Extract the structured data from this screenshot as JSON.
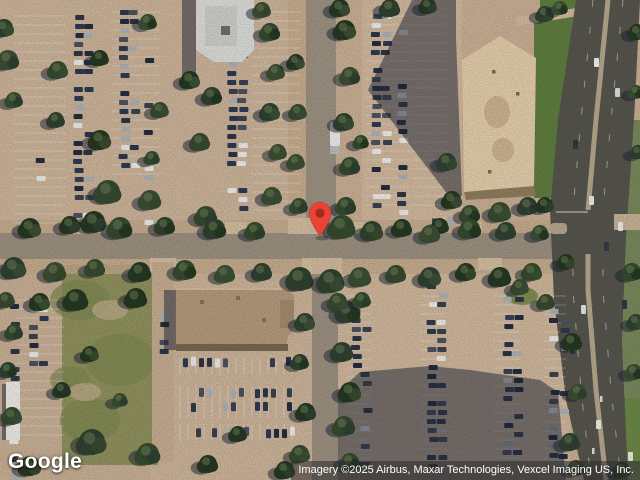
{
  "map": {
    "view": "satellite",
    "logo": "Google",
    "attribution": "Imagery ©2025 Airbus, Maxar Technologies, Vexcel Imaging US, Inc."
  },
  "marker": {
    "shape": "teardrop-pin",
    "color": "#EA4335",
    "dot_color": "#9E2B1F"
  },
  "palette": {
    "pavement": "#c6ad92",
    "road": "#9a8e7e",
    "main_road": "#55544c",
    "median": "#b3a58c",
    "grass": "#5e7c3e",
    "field": "#8e8f5d",
    "shadow": "rgba(28,36,56,0.5)",
    "building_tan": "#e0cba8",
    "building_white": "#d9d9d5",
    "building_brown": "#b2987b",
    "stripe": "#ffffff"
  }
}
